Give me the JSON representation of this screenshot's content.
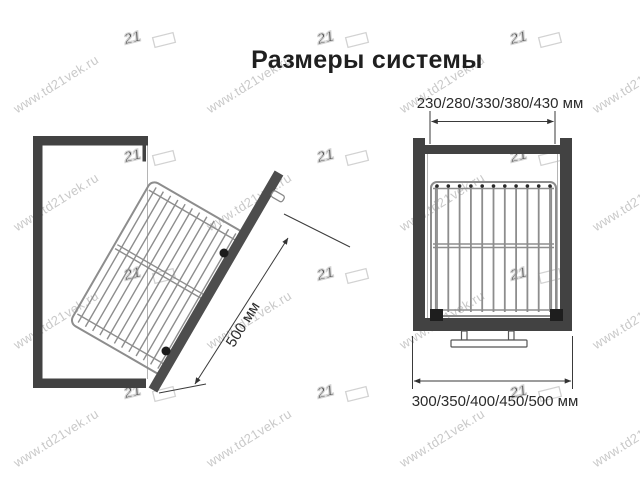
{
  "title": "Размеры системы",
  "left_view": {
    "dim_label": "500 мм"
  },
  "right_view": {
    "top_dim_label": "230/280/330/380/430 мм",
    "bottom_dim_label": "300/350/400/450/500 мм"
  },
  "watermark": {
    "text": "www.td21vek.ru",
    "logo": "21"
  },
  "colors": {
    "frame": "#424242",
    "rail": "#4d4d4d",
    "wire": "#8d8d8d",
    "dimension": "#3a3a3a",
    "label_text": "#2b2b2b",
    "watermark": "#c9c9c9",
    "background": "#ffffff"
  }
}
